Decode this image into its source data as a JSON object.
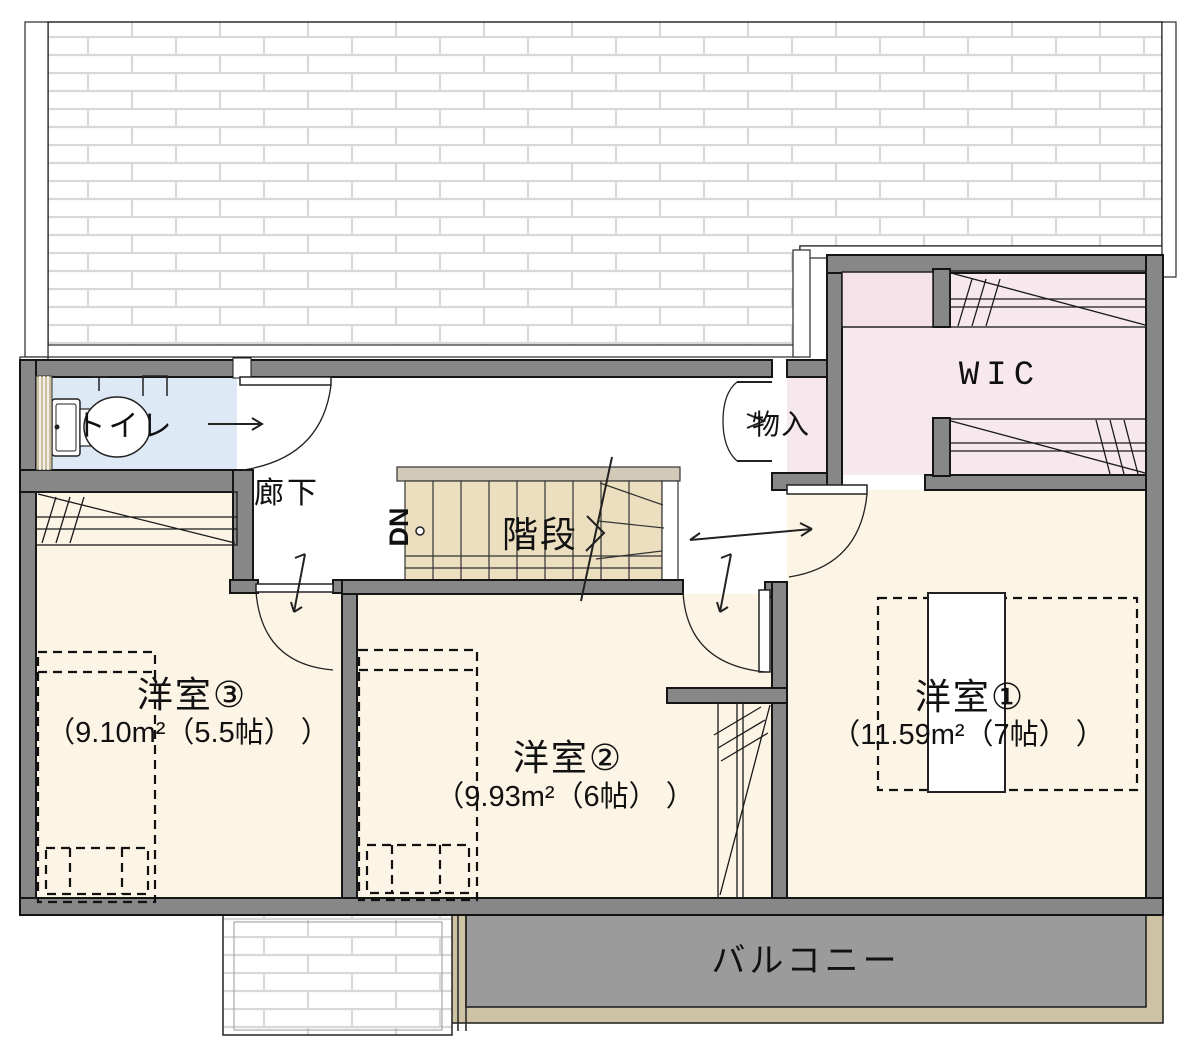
{
  "plan_type": "floor-plan",
  "floor": "2F",
  "rooms": [
    {
      "id": "toilet",
      "label": "トイレ"
    },
    {
      "id": "hallway",
      "label": "廊下"
    },
    {
      "id": "stairs",
      "label": "階段",
      "direction": "DN"
    },
    {
      "id": "storage",
      "label": "物入"
    },
    {
      "id": "wic",
      "label": "WIC"
    },
    {
      "id": "bedroom1",
      "label": "洋室①",
      "area": "（11.59m²（7帖） ）"
    },
    {
      "id": "bedroom2",
      "label": "洋室②",
      "area": "（9.93m²（6帖） ）"
    },
    {
      "id": "bedroom3",
      "label": "洋室③",
      "area": "（9.10m²（5.5帖） ）"
    },
    {
      "id": "balcony",
      "label": "バルコニー"
    }
  ],
  "colors": {
    "wall": "#878787",
    "room_floor": "#fcf4e5",
    "toilet_floor": "#dde9f5",
    "closet_pink": "#f6e8ec",
    "stair_tread": "#ecdfc0",
    "stair_band": "#d2c9b8",
    "balcony_floor": "#9b9b9b",
    "balcony_trim": "#cdc2a4",
    "roof_mortar_line": "#d8d8d8"
  }
}
